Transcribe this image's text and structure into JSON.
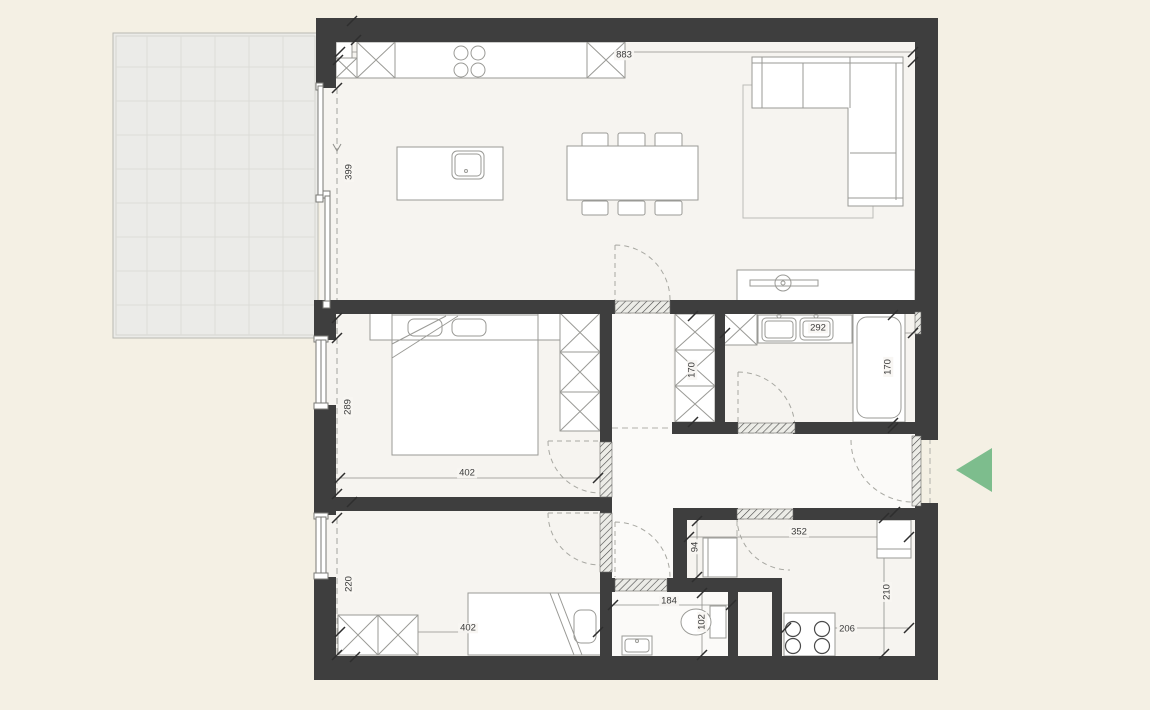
{
  "meta": {
    "kind": "apartment-floor-plan"
  },
  "colors": {
    "background": "#f4f0e4",
    "wall": "#3e3e3e",
    "floor": "#f6f4f0",
    "hall_floor": "#fbfaf8",
    "terrace": "#ebebe8",
    "accent_green": "#7dbd8d",
    "furn_line": "#9a9a96",
    "dim_line": "#8f8f8b",
    "text": "#3a3a3a"
  },
  "icons": {
    "entrance_arrow": "triangle-pointing-left"
  },
  "dimensions": [
    {
      "id": "living-width",
      "label": "883",
      "orient": "h"
    },
    {
      "id": "living-height",
      "label": "399",
      "orient": "v"
    },
    {
      "id": "bedroom1-height",
      "label": "289",
      "orient": "v"
    },
    {
      "id": "bedroom1-width",
      "label": "402",
      "orient": "h"
    },
    {
      "id": "bedroom2-height",
      "label": "220",
      "orient": "v"
    },
    {
      "id": "bedroom2-width",
      "label": "402",
      "orient": "h"
    },
    {
      "id": "hall-wardrobe-height",
      "label": "170",
      "orient": "v"
    },
    {
      "id": "bathroom-width",
      "label": "292",
      "orient": "h"
    },
    {
      "id": "bathroom-height",
      "label": "170",
      "orient": "v"
    },
    {
      "id": "storage-width",
      "label": "352",
      "orient": "h"
    },
    {
      "id": "niche-height",
      "label": "94",
      "orient": "v"
    },
    {
      "id": "wc-width",
      "label": "184",
      "orient": "h"
    },
    {
      "id": "wc-height",
      "label": "102",
      "orient": "v"
    },
    {
      "id": "kitchenette-width",
      "label": "206",
      "orient": "h"
    },
    {
      "id": "storage-height",
      "label": "210",
      "orient": "v"
    }
  ]
}
